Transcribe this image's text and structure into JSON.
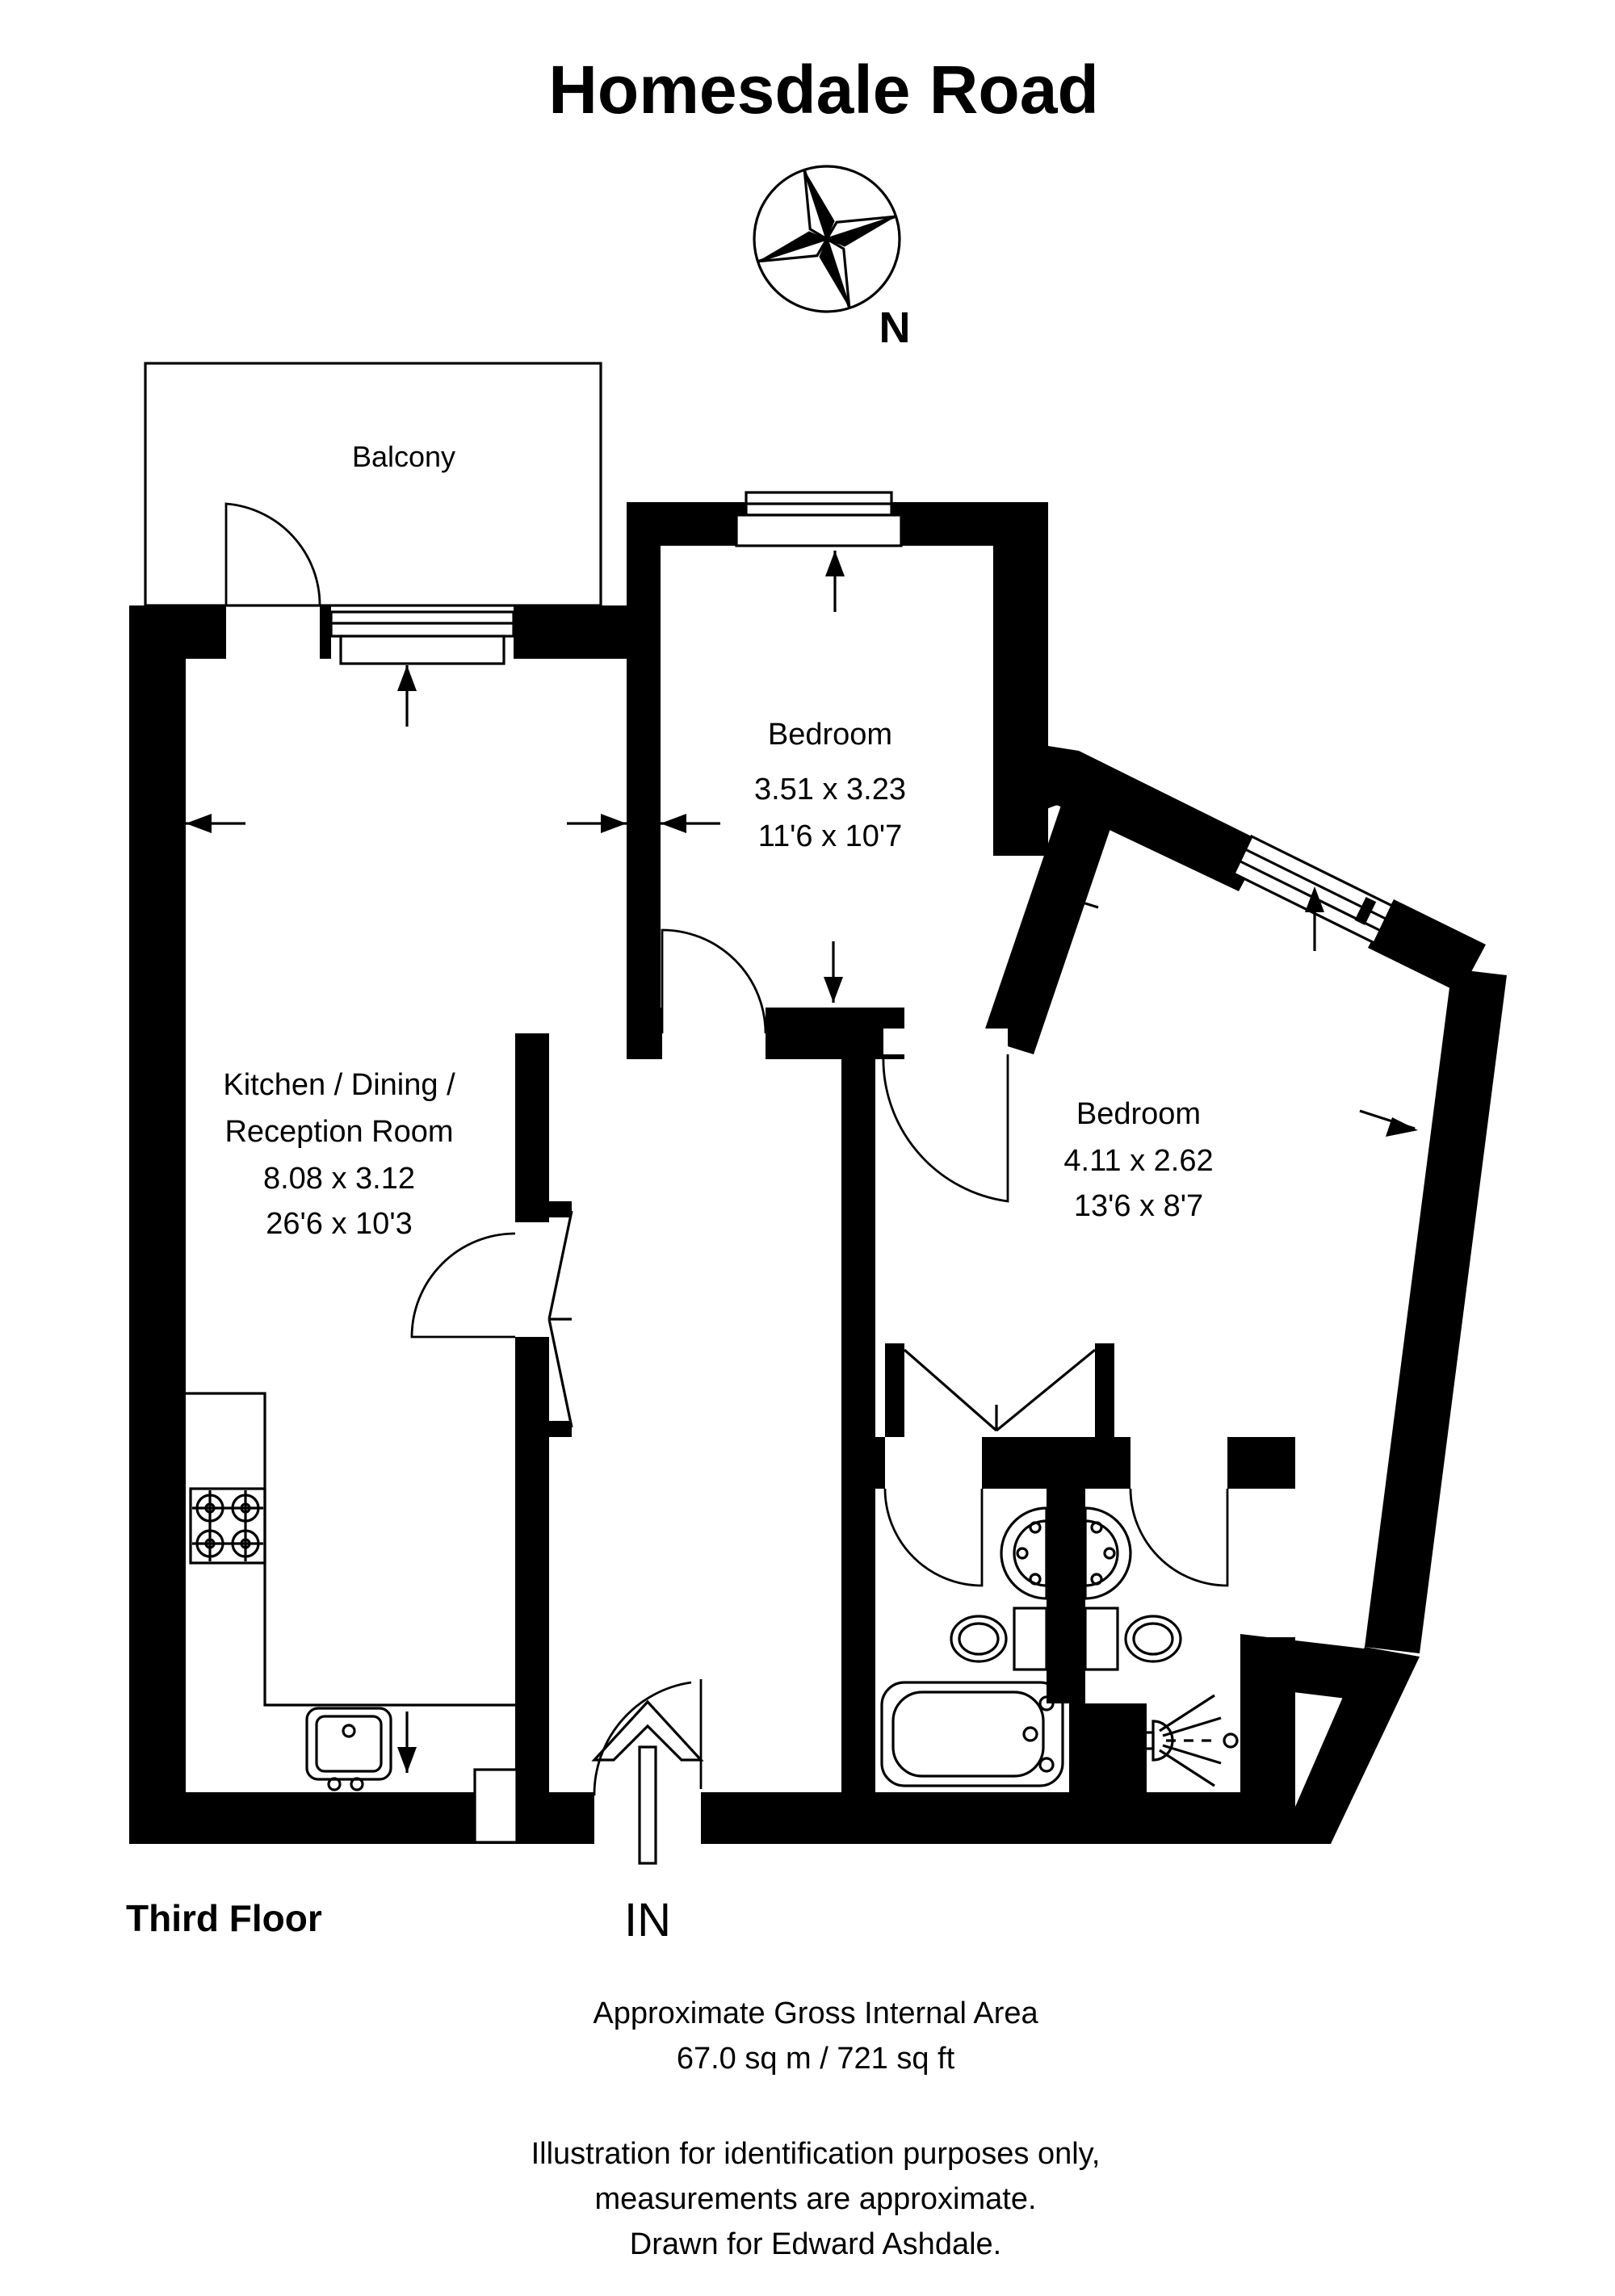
{
  "title": "Homesdale Road",
  "compass": {
    "label": "N"
  },
  "plan": {
    "balcony": {
      "label": "Balcony"
    },
    "bedroom_top": {
      "label": "Bedroom",
      "metric": "3.51 x 3.23",
      "imperial": "11'6 x 10'7"
    },
    "bedroom_right": {
      "label": "Bedroom",
      "metric": "4.11 x 2.62",
      "imperial": "13'6 x 8'7"
    },
    "kitchen": {
      "label_line1": "Kitchen / Dining /",
      "label_line2": "Reception Room",
      "metric": "8.08 x 3.12",
      "imperial": "26'6 x 10'3"
    },
    "entrance": {
      "label": "IN"
    }
  },
  "footer": {
    "floor": "Third Floor",
    "area_line1": "Approximate Gross Internal Area",
    "area_line2": "67.0 sq m / 721 sq ft",
    "disclaimer_line1": "Illustration for identification purposes only,",
    "disclaimer_line2": "measurements are approximate.",
    "disclaimer_line3": "Drawn for Edward Ashdale."
  },
  "colors": {
    "wall": "#000000",
    "background": "#ffffff"
  }
}
